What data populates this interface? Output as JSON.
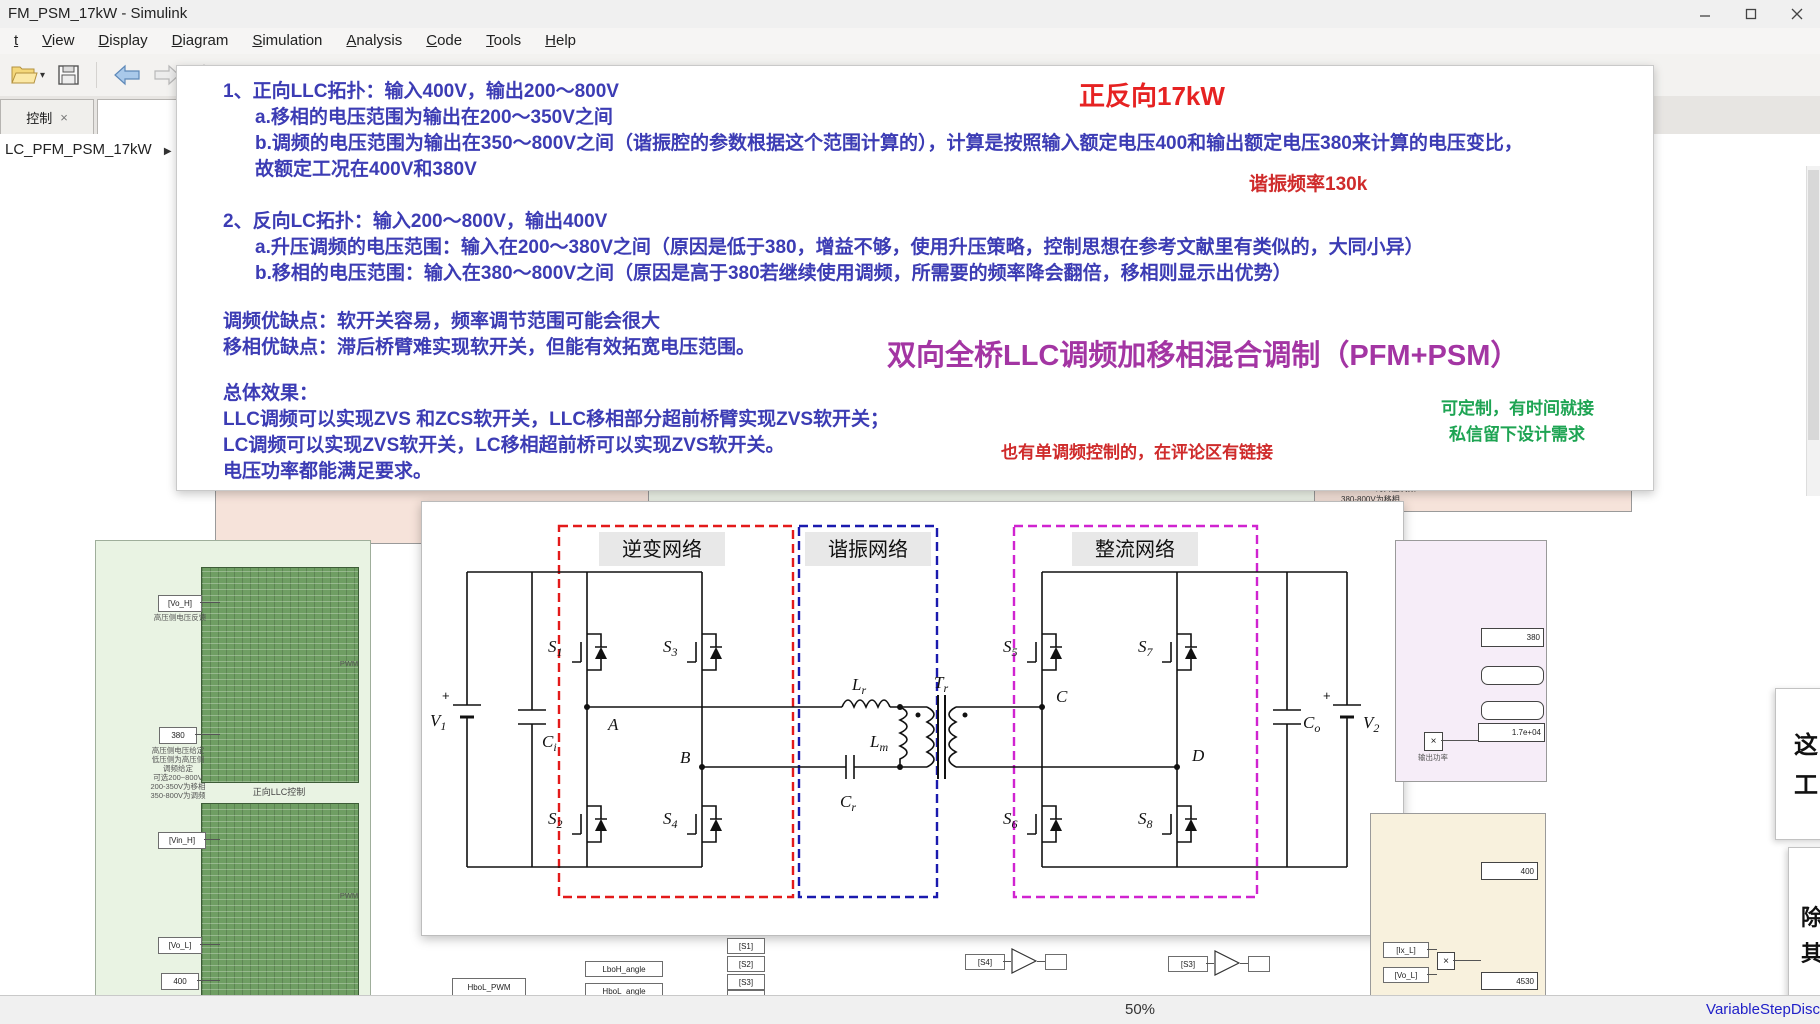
{
  "window": {
    "title": "FM_PSM_17kW - Simulink"
  },
  "menu": {
    "items": [
      {
        "label": "t"
      },
      {
        "label": "View"
      },
      {
        "label": "Display"
      },
      {
        "label": "Diagram"
      },
      {
        "label": "Simulation"
      },
      {
        "label": "Analysis"
      },
      {
        "label": "Code"
      },
      {
        "label": "Tools"
      },
      {
        "label": "Help"
      }
    ]
  },
  "toolbar": {
    "caret": "▾"
  },
  "tabs": {
    "tab1_label": "控制",
    "tab1_close": "×",
    "tab2_label": "LLC_PFM_PSM_1"
  },
  "breadcrumb": {
    "model": "LC_PFM_PSM_17kW",
    "arrow": "▶"
  },
  "annotation": {
    "sec1_title": "1、正向LLC拓扑：输入400V，输出200～800V",
    "sec1_a": "a.移相的电压范围为输出在200～350V之间",
    "sec1_b": "b.调频的电压范围为输出在350～800V之间（谐振腔的参数根据这个范围计算的），计算是按照输入额定电压400和输出额定电压380来计算的电压变比，",
    "sec1_c": "故额定工况在400V和380V",
    "red_title": "正反向17kW",
    "res_note": "谐振频率130k",
    "sec2_title": "2、反向LC拓扑：输入200～800V，输出400V",
    "sec2_a": "a.升压调频的电压范围：输入在200～380V之间（原因是低于380，增益不够，使用升压策略，控制思想在参考文献里有类似的，大同小异）",
    "sec2_b": "b.移相的电压范围：输入在380～800V之间（原因是高于380若继续使用调频，所需要的频率降会翻倍，移相则显示出优势）",
    "pros1": "调频优缺点：软开关容易，频率调节范围可能会很大",
    "pros2": "移相优缺点：滞后桥臂难实现软开关，但能有效拓宽电压范围。",
    "purple_title": "双向全桥LLC调频加移相混合调制（PFM+PSM）",
    "overall_title": "总体效果：",
    "overall1": "LLC调频可以实现ZVS 和ZCS软开关，LLC移相部分超前桥臂实现ZVS软开关；",
    "overall2": "LC调频可以实现ZVS软开关，LC移相超前桥可以实现ZVS软开关。",
    "overall3": "电压功率都能满足要求。",
    "red_note": "也有单调频控制的，在评论区有链接",
    "green_note1": "可定制，有时间就接",
    "green_note2": "私信留下设计需求"
  },
  "circuit": {
    "sections": {
      "inverter": "逆变网络",
      "resonant": "谐振网络",
      "rectifier": "整流网络"
    },
    "components": {
      "v1": {
        "t": "V",
        "s": "1"
      },
      "ci": {
        "t": "C",
        "s": "i"
      },
      "s1": {
        "t": "S",
        "s": "1"
      },
      "s2": {
        "t": "S",
        "s": "2"
      },
      "s3": {
        "t": "S",
        "s": "3"
      },
      "s4": {
        "t": "S",
        "s": "4"
      },
      "s5": {
        "t": "S",
        "s": "5"
      },
      "s6": {
        "t": "S",
        "s": "6"
      },
      "s7": {
        "t": "S",
        "s": "7"
      },
      "s8": {
        "t": "S",
        "s": "8"
      },
      "lr": {
        "t": "L",
        "s": "r"
      },
      "lm": {
        "t": "L",
        "s": "m"
      },
      "cr": {
        "t": "C",
        "s": "r"
      },
      "tr": {
        "t": "T",
        "s": "r"
      },
      "co": {
        "t": "C",
        "s": "o"
      },
      "v2": {
        "t": "V",
        "s": "2"
      },
      "a": "A",
      "b": "B",
      "c": "C",
      "d": "D",
      "plus": "+"
    }
  },
  "canvas": {
    "top_note_lines": [
      "200-380V为升压调频",
      "380-800V为移相"
    ],
    "left_panel": {
      "tag_vo_h": "[Vo_H]",
      "caption_vo_h": "高压侧电压反馈",
      "const_380": "380",
      "caption_380_lines": [
        "高压侧电压给定",
        "低压侧为高压侧",
        "调频给定",
        "可选200~800V",
        "200-350V为移相",
        "350-800V为调频"
      ],
      "block1_caption": "正向LLC控制",
      "pwm_label": "PWM",
      "tag_vin_h": "[Vin_H]",
      "tag_vo_l": "[Vo_L]",
      "const_400": "400"
    },
    "right_panel": {
      "display_380": "380",
      "display_17e04": "1.7e+04",
      "product": "×",
      "caption": "输出功率"
    },
    "bottom_right_panel": {
      "display_400": "400",
      "display_4530": "4530",
      "tag_ix_l": "[Ix_L]",
      "tag_vo_l": "[Vo_L]",
      "product": "×"
    },
    "bottom_blocks": {
      "hbol_pwm": "HboL_PWM",
      "lboh_angle": "LboH_angle",
      "hbol_angle": "HboL_angle",
      "tags": [
        "[S1]",
        "[S2]",
        "[S3]",
        "[S4]"
      ],
      "g1_tag": "[S4]",
      "g2_tag": "[S3]"
    },
    "right_cards": {
      "card1_lines": [
        "这",
        "工"
      ],
      "card2_lines": [
        "除",
        "其"
      ]
    }
  },
  "statusbar": {
    "zoom": "50%",
    "solver": "VariableStepDisc"
  }
}
